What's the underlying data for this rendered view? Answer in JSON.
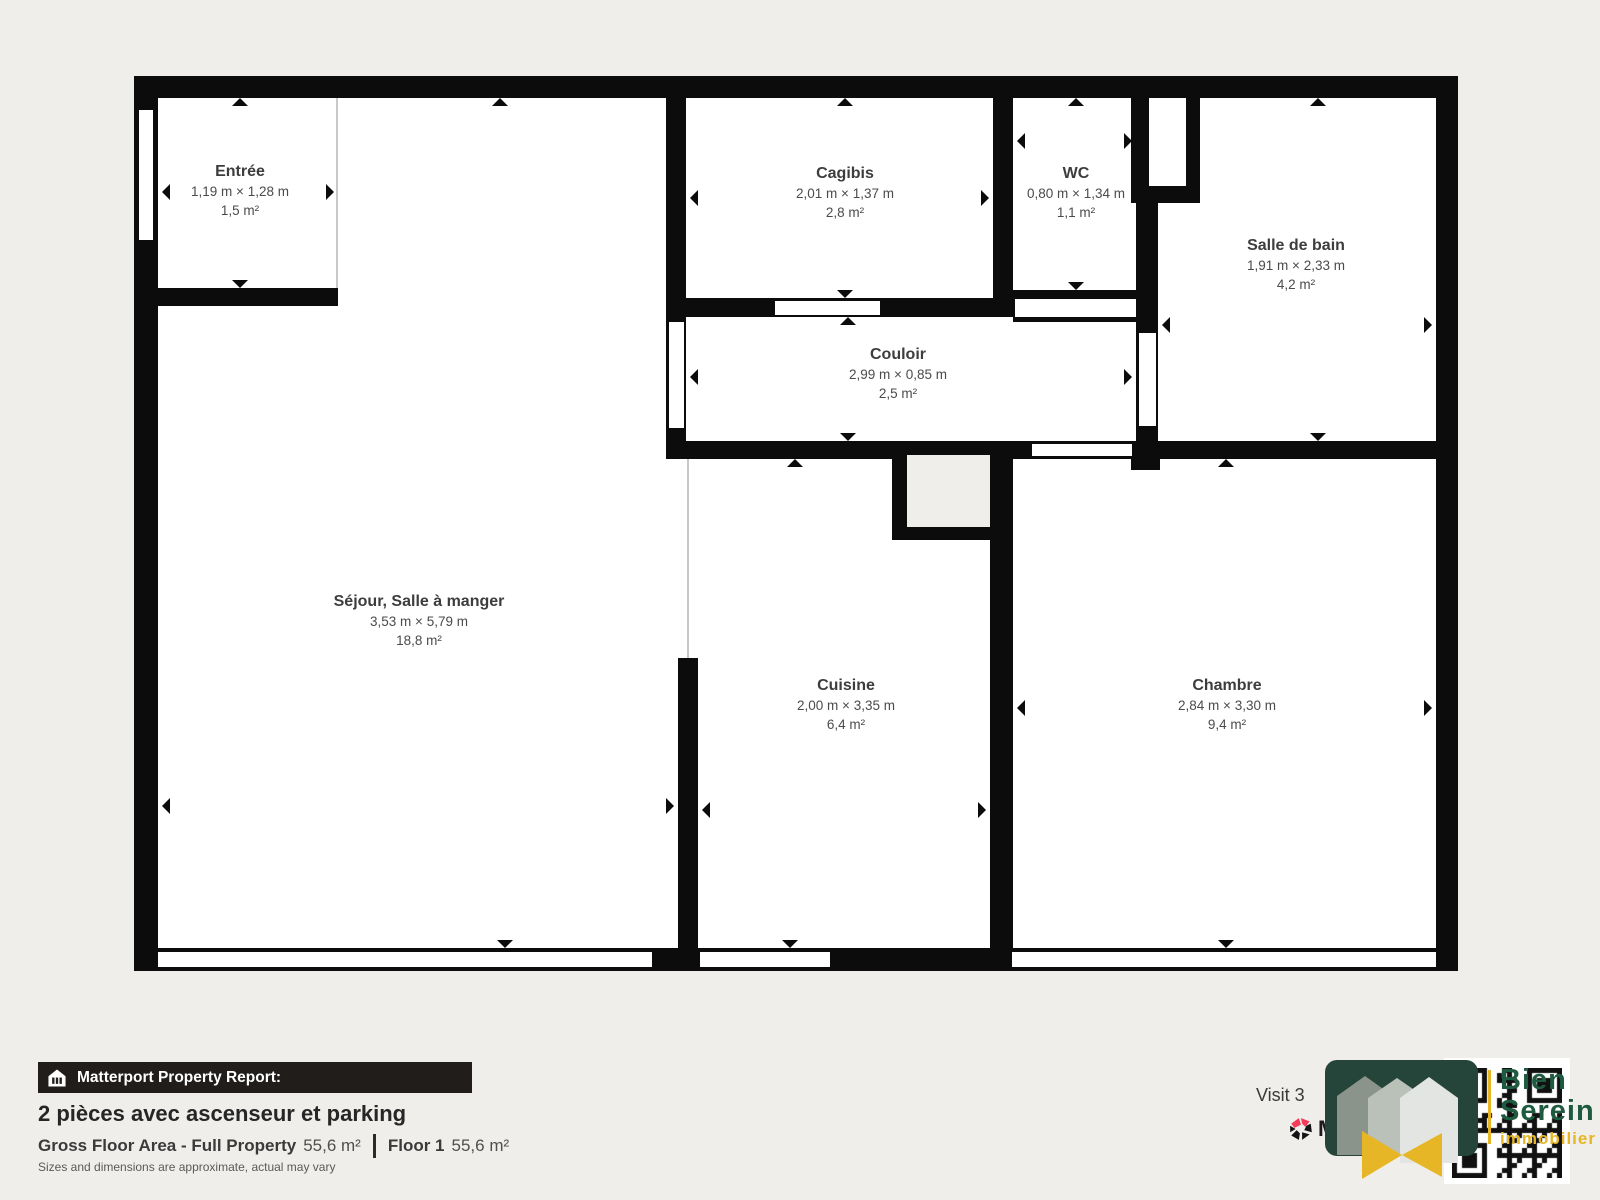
{
  "colors": {
    "page_bg": "#f0eeeb",
    "wall": "#0c0c0c",
    "room_fill": "#ffffff",
    "thin_line": "#c8c8c8",
    "label_name": "#3d3d3d",
    "label_dims": "#4b4b4b",
    "report_bar_bg": "#201d1b",
    "agency_green": "#26453a",
    "agency_text_green": "#1d5a3f",
    "agency_yellow": "#e7b626",
    "matterport_red": "#f43b57"
  },
  "plan": {
    "base": [
      134,
      76,
      1324,
      895
    ],
    "walls": [
      {
        "n": "wall-top",
        "r": [
          134,
          76,
          1324,
          22
        ]
      },
      {
        "n": "wall-left",
        "r": [
          134,
          76,
          24,
          895
        ]
      },
      {
        "n": "wall-right",
        "r": [
          1436,
          76,
          22,
          895
        ]
      },
      {
        "n": "wall-bottom",
        "r": [
          134,
          948,
          1324,
          23
        ]
      },
      {
        "n": "wall-entree-bottom",
        "r": [
          134,
          288,
          204,
          18
        ]
      },
      {
        "n": "wall-cagibis-left",
        "r": [
          666,
          98,
          20,
          360
        ]
      },
      {
        "n": "wall-cagibis-bottom",
        "r": [
          666,
          298,
          347,
          19
        ]
      },
      {
        "n": "wall-wc-divider",
        "r": [
          993,
          98,
          20,
          202
        ]
      },
      {
        "n": "wall-wc-bottom",
        "r": [
          1013,
          290,
          145,
          32
        ]
      },
      {
        "n": "wall-shaft-top-block",
        "r": [
          1131,
          76,
          69,
          127
        ]
      },
      {
        "n": "wall-sdb-left",
        "r": [
          1136,
          203,
          22,
          256
        ]
      },
      {
        "n": "wall-couloir-bottom",
        "r": [
          666,
          441,
          770,
          18
        ]
      },
      {
        "n": "wall-sdb-bottom-corner",
        "r": [
          1131,
          441,
          29,
          29
        ]
      },
      {
        "n": "wall-shaft-left",
        "r": [
          892,
          441,
          15,
          99
        ]
      },
      {
        "n": "wall-shaft-bottom",
        "r": [
          892,
          526,
          121,
          14
        ]
      },
      {
        "n": "wall-cuisine-chambre-divider",
        "r": [
          990,
          441,
          23,
          530
        ]
      },
      {
        "n": "wall-sejour-cuisine",
        "r": [
          678,
          658,
          20,
          313
        ]
      }
    ],
    "openings": [
      {
        "n": "entree-window",
        "r": [
          137,
          108,
          18,
          134
        ],
        "outlined": true
      },
      {
        "n": "cagibis-door",
        "r": [
          775,
          301,
          105,
          14
        ],
        "outlined": false
      },
      {
        "n": "wc-door",
        "r": [
          1015,
          299,
          121,
          18
        ],
        "outlined": false
      },
      {
        "n": "couloir-left-door",
        "r": [
          669,
          322,
          15,
          106
        ],
        "outlined": false
      },
      {
        "n": "shaft-pocket",
        "r": [
          1149,
          98,
          37,
          88
        ],
        "outlined": false
      },
      {
        "n": "sdb-door",
        "r": [
          1139,
          333,
          17,
          93
        ],
        "outlined": false
      },
      {
        "n": "chambre-door",
        "r": [
          1032,
          444,
          100,
          12
        ],
        "outlined": false
      },
      {
        "n": "window-sejour",
        "r": [
          158,
          952,
          494,
          15
        ],
        "outlined": false
      },
      {
        "n": "window-cuisine",
        "r": [
          700,
          952,
          130,
          15
        ],
        "outlined": false
      },
      {
        "n": "window-chambre",
        "r": [
          1012,
          952,
          424,
          15
        ],
        "outlined": false
      }
    ],
    "gray_areas": [
      {
        "n": "shaft-void",
        "r": [
          907,
          455,
          83,
          72
        ]
      }
    ],
    "thin_lines": [
      {
        "n": "entree-open-boundary",
        "r": [
          336,
          98,
          2,
          190
        ]
      },
      {
        "n": "sejour-cuisine-open-boundary",
        "r": [
          687,
          459,
          2,
          199
        ]
      }
    ],
    "rooms": [
      {
        "id": "entree",
        "name": "Entrée",
        "dims": "1,19 m × 1,28 m",
        "area": "1,5 m²",
        "cx": 240,
        "ty": 162,
        "arrows": [
          [
            240,
            98,
            "up"
          ],
          [
            240,
            288,
            "down"
          ],
          [
            162,
            192,
            "left"
          ],
          [
            334,
            192,
            "right"
          ]
        ]
      },
      {
        "id": "cagibis",
        "name": "Cagibis",
        "dims": "2,01 m × 1,37 m",
        "area": "2,8 m²",
        "cx": 845,
        "ty": 164,
        "arrows": [
          [
            845,
            98,
            "up"
          ],
          [
            845,
            298,
            "down"
          ],
          [
            690,
            198,
            "left"
          ],
          [
            989,
            198,
            "right"
          ]
        ]
      },
      {
        "id": "wc",
        "name": "WC",
        "dims": "0,80 m × 1,34 m",
        "area": "1,1 m²",
        "cx": 1076,
        "ty": 164,
        "arrows": [
          [
            1076,
            98,
            "up"
          ],
          [
            1076,
            290,
            "down"
          ],
          [
            1017,
            141,
            "left"
          ],
          [
            1132,
            141,
            "right"
          ]
        ]
      },
      {
        "id": "salle-de-bain",
        "name": "Salle de bain",
        "dims": "1,91 m × 2,33 m",
        "area": "4,2 m²",
        "cx": 1296,
        "ty": 236,
        "arrows": [
          [
            1318,
            98,
            "up"
          ],
          [
            1318,
            441,
            "down"
          ],
          [
            1162,
            325,
            "left"
          ],
          [
            1432,
            325,
            "right"
          ]
        ]
      },
      {
        "id": "couloir",
        "name": "Couloir",
        "dims": "2,99 m × 0,85 m",
        "area": "2,5 m²",
        "cx": 898,
        "ty": 345,
        "arrows": [
          [
            848,
            317,
            "up"
          ],
          [
            848,
            441,
            "down"
          ],
          [
            690,
            377,
            "left"
          ],
          [
            1132,
            377,
            "right"
          ]
        ]
      },
      {
        "id": "sejour",
        "name": "Séjour, Salle à manger",
        "dims": "3,53 m × 5,79 m",
        "area": "18,8 m²",
        "cx": 419,
        "ty": 592,
        "arrows": [
          [
            500,
            98,
            "up"
          ],
          [
            505,
            948,
            "down"
          ],
          [
            162,
            806,
            "left"
          ],
          [
            674,
            806,
            "right"
          ]
        ]
      },
      {
        "id": "cuisine",
        "name": "Cuisine",
        "dims": "2,00 m × 3,35 m",
        "area": "6,4 m²",
        "cx": 846,
        "ty": 676,
        "arrows": [
          [
            795,
            459,
            "up"
          ],
          [
            790,
            948,
            "down"
          ],
          [
            702,
            810,
            "left"
          ],
          [
            986,
            810,
            "right"
          ]
        ]
      },
      {
        "id": "chambre",
        "name": "Chambre",
        "dims": "2,84 m × 3,30 m",
        "area": "9,4 m²",
        "cx": 1227,
        "ty": 676,
        "arrows": [
          [
            1226,
            459,
            "up"
          ],
          [
            1226,
            948,
            "down"
          ],
          [
            1017,
            708,
            "left"
          ],
          [
            1432,
            708,
            "right"
          ]
        ]
      }
    ]
  },
  "footer": {
    "report_label": "Matterport Property Report:",
    "title": "2 pièces avec ascenseur et parking",
    "gfa_label": "Gross Floor Area - Full Property",
    "gfa_value": "55,6 m²",
    "floor_label": "Floor 1",
    "floor_value": "55,6 m²",
    "disclaimer": "Sizes and dimensions are approximate, actual may vary"
  },
  "branding": {
    "visit_text": "Visit 3",
    "matterport_partial": "M",
    "agency_line1": "Bien",
    "agency_line2": "Serein",
    "agency_line3": "immobilier"
  }
}
